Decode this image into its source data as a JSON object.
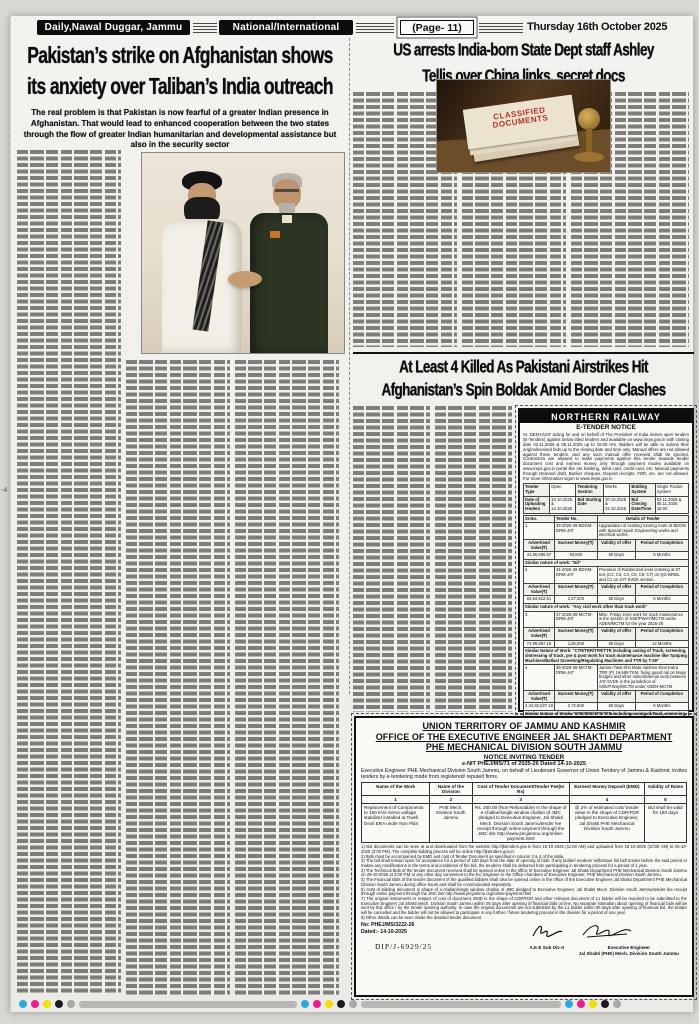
{
  "masthead": {
    "paper_name": "Daily,Nawal Duggar, Jammu",
    "section": "National/International",
    "page": "(Page- 11)",
    "date": "Thursday 16th October 2025"
  },
  "article_left": {
    "headline_line1": "Pakistan’s strike on Afghanistan shows",
    "headline_line2": "its anxiety over Taliban’s India outreach",
    "standfirst": "The real problem is that Pakistan is now fearful of a greater Indian presence in Afghanistan. That would lead to enhanced cooperation between the two states through the flow of greater Indian humanitarian and developmental assistance but also in the security sector"
  },
  "article_right": {
    "headline_line1": "US arrests India-born State Dept staff Ashley",
    "headline_line2": "Tellis over China links, secret docs",
    "photo_stamp_line1": "CLASSIFIED",
    "photo_stamp_line2": "DOCUMENTS"
  },
  "article_middle": {
    "headline_line1": "At Least 4 Killed As Pakistani Airstrikes Hit",
    "headline_line2": "Afghanistan’s Spin Boldak Amid Border Clashes"
  },
  "railway_notice": {
    "title": "NORTHERN RAILWAY",
    "subtitle": "E-TENDER NOTICE",
    "intro": "Sr. DEN-II/JAT acting for and on behalf of The President of India invites open tenders (E-Tenders) against below titled tenders and available on www.ireps.gov.in with closing date 03.11.2025 & 05.11.2025 up to 15:00 Hrs. Bidders will be able to submit their original/revised bids up to the closing date and time only. Manual offers are not allowed against these tenders, and any such manual offer received shall be ignored. Contractors are allowed to make payments against this tender towards tender document cost and earnest money only through payment modes available on www.ireps.gov.in portal like net banking, debit card, credit card, etc. Manual payments through Demand draft, Banker cheques, Deposit receipts, FDR, etc. are not allowed. For more information logon to www.ireps.gov.in",
    "meta": {
      "tender_type_label": "Tender Type",
      "tender_type": "Open",
      "section_label": "Tendering Section",
      "section": "Works",
      "bidding_label": "Bidding System",
      "bidding": "Single Packet System",
      "uploading_label": "Date of Uploading tenders",
      "uploading": "10.10.2025 & 14.10.2025",
      "bid_start_label": "Bid Starting Date",
      "bid_start": "20.10.2025 & 22.10.2025",
      "bid_close_label": "Bid Closing Date/Time",
      "bid_close": "03.11.2025 & 05.11.2025 15:00"
    },
    "col_headers": {
      "sr": "Sr.No.",
      "tender_no": "Tender No.",
      "details": "Details of Tender",
      "adv": "Advertised Value(₹)",
      "emd": "Earnest Money(₹)",
      "validity": "Validity of offer",
      "period": "Period of Completion"
    },
    "tenders": [
      {
        "sr": "1.",
        "no": "33-2025-26-BDGM-DRM-JAT",
        "details": "Upgradation of existing running room at BDGM with Special repair, Engineering works and electrical works.",
        "adv": "41,90,695.97",
        "emd": "83,800",
        "validity": "60 Days",
        "period": "6 Months",
        "similar": "Similar nature of work: \"Nil\""
      },
      {
        "sr": "2.",
        "no": "34-2025-26-BDGM-DRM-JAT",
        "details": "Provision of Rubberized level crossing at 07 nos (C1, C3, C4, C5, C6, C7) on QG-BRML and C1 on JAT-SVDK section.",
        "adv": "63,64,812.51",
        "emd": "1,27,300",
        "validity": "60 Days",
        "period": "6 Months",
        "similar": "Similar nature of work: \"Any civil work other than track work\""
      },
      {
        "sr": "3.",
        "no": "37-2025-26-MCTM-DRM-JAT",
        "details": "Misc. P.Way zone work for track maintenance in the section of SSE/PWAY/MCTM under ADEN/MCTM for the year 2025-26",
        "adv": "74,99,857.18",
        "emd": "1,50,000",
        "validity": "60 Days",
        "period": "12 Months",
        "similar": "Similar Nature of Work: \"CTR/TRR/TFR/TTR including casing of Track, screening, distressing of track, pre & post work for track maintenance machine like Tamping Machines/Ballast Screening/Regulating Machines and TTR by T-28\""
      },
      {
        "sr": "4.",
        "no": "39-2025-26-MCTM-DRM-JAT",
        "details": "Jammu Tawi-Shri Mata Vaishno Devi Katra TRR (P) 16-588 TKM, fixing guard rail on Major bridges and other miscellaneous work between JAT-SVDK in the jurisdiction of SSE/P.Way/MCTM under ADEN-MCTM",
        "adv": "2,44,92,027.18",
        "emd": "2,72,500",
        "validity": "60 Days",
        "period": "6 Months",
        "similar": "Similar Nature of Work: \"CTR/TRR/TFR/TTR including casing of Track, screening, distressing of track, pre & post work for track maintenance machine like Tamping Machines/Ballast Screening/Regulating Machines and TTR by T-28\""
      }
    ],
    "note": "NOTE: Before bidding, bidders to check for any corrigendum issued against tender No.: 33, 34, 37, 39-2025-26-BDGM-DRM-JAT",
    "dated": "Dated: 14.10.2025",
    "ref": "317T/2025",
    "footer": "SERVING CUSTOMERS WITH A SMILE"
  },
  "phe_notice": {
    "heading1": "UNION TERRITORY OF JAMMU AND KASHMIR",
    "heading2": "OFFICE OF THE EXECUTIVE ENGINEER JAL SHAKTI DEPARTMENT",
    "heading3": "PHE MECHANICAL DIVISION SOUTH JAMMU",
    "subheading": "NOTICE INVITING TENDER",
    "nit_ref": "e-NIT PHEJ/MS/71 of 2025-26 Dated 14-10-2025",
    "intro": "Executive Engineer PHE Mechanical Division South Jammu, on behalf of Lieutenant Governor of Union Territory of Jammu & Kashmir, invites tenders by e-tendering mode from registered/ reputed firms.",
    "table": {
      "h1": "Name of the Work",
      "h2": "Name of the Division",
      "h3": "Cost of Tender Document/Tender Fee(In Rs)",
      "h4": "Earnest Money Deposit (EMD)",
      "h5": "Validity of Rates",
      "n1": "1",
      "n2": "2",
      "n3": "3",
      "n4": "4",
      "n5": "5",
      "work": "Replacement of Components to 150 KVA Servo voltage stabilizer installed at Tiwell Deoli ERA under Non Plan",
      "division": "PHE Mech. Division South Jammu",
      "cost": "Rs. 200.00 (Non-Refundable) In the shape of e-challan/single window challan of JMC pledged to Executive Engineer, Jal Shakti Mech. Division South Jammu/tender fee receipt through online payment through the JMC link http://www.jmcjammu.org/online-payment.html",
      "emd": "@ 2% of estimated cost/ tender value in the shape of CDR/FDR pledged to Executive Engineer, Jal Shakti PHE Mechanical Division South Jammu",
      "validity": "Bid shall be valid for 180 days"
    },
    "conditions": [
      "1) Bid documents can be seen at and downloaded from the website http://jktenders.gov.in from 15-10-2025 (11:00 AM) and uploaded from 15-10-2025 (10:00 AM) to 25-10-2025 (3:00 PM). The complete bidding process will be online http://jktenders.gov.in",
      "2) Bids must be accompanied by EMD and cost of Tender Document as specified in column 3 & 4 of the table.",
      "3) The bid shall remain open for acceptance for a period of 180 days from the date of opening of bids. If any bidder/ tenderer withdraws his bid/ tender before the said period or makes any modifications in the terms and conditions of the bid, the tenderer shall be debarred from participating in tendering process for a period of 1 year.",
      "4) The Technical Bids of the tender document received shall be opened online in the office of Executive Engineer Jal Shakti Department PHE Mechanical Division South Jammu on 29-10-2025 at 3:00 P.M or any other day convenient to the Ex. Engineer in the Office chambers of Executive Engineer, PHE Mechanical Division South Jammu.",
      "5) The Financial Bids of the tender document of the qualified bidders shall also be opened online in the office of the Executive Engineer Jal Shakti Department PHE Mechanical Division South Jammu during office hours and shall be communicated separately.",
      "6) Cost of bidding document in shape of e-challan/single window challan of JMC pledged to Executive Engineer, Jal Shakti Mech. Division South Jammu/tender fee receipt through online payment through the JMC link http://www.jmcjammu.org/online-payment.html",
      "7) The original instruments in respect of cost of document, EMD in the shape of CDR/FDR and other relevant document of L1 bidder will be required to be submitted to the Executive Engineer Jal Shakti Mech. Division South Jammu within 05 days after opening of financial bids on line. No separate intimation about opening of financial bids will be sent by this office / by the tender opening authority. In case the original documents are not submitted by the L1 bidder within 05 days after opening of financial bid, the tender will be cancelled and the bidder will not be allowed to participate in any further / future tendering process in the division for a period of one year.",
      "8) Other details can be seen inside the detailed tender document."
    ],
    "ref_no": "No: PHEJ/MS/3222-26",
    "dated": "Dated:- 14-10-2025",
    "dip": "DIP/J-6929/25",
    "sign_left": "A.E.E Sub Div-II",
    "sign_right_line1": "Executive Engineer",
    "sign_right_line2": "Jal Shakti (PHE) Mech. Division South Jammu"
  },
  "margin_note": "-4",
  "colors": {
    "masthead_bar": "#0c0c0c",
    "stamp_red": "#b23327",
    "paper": "#f2f1ed"
  }
}
